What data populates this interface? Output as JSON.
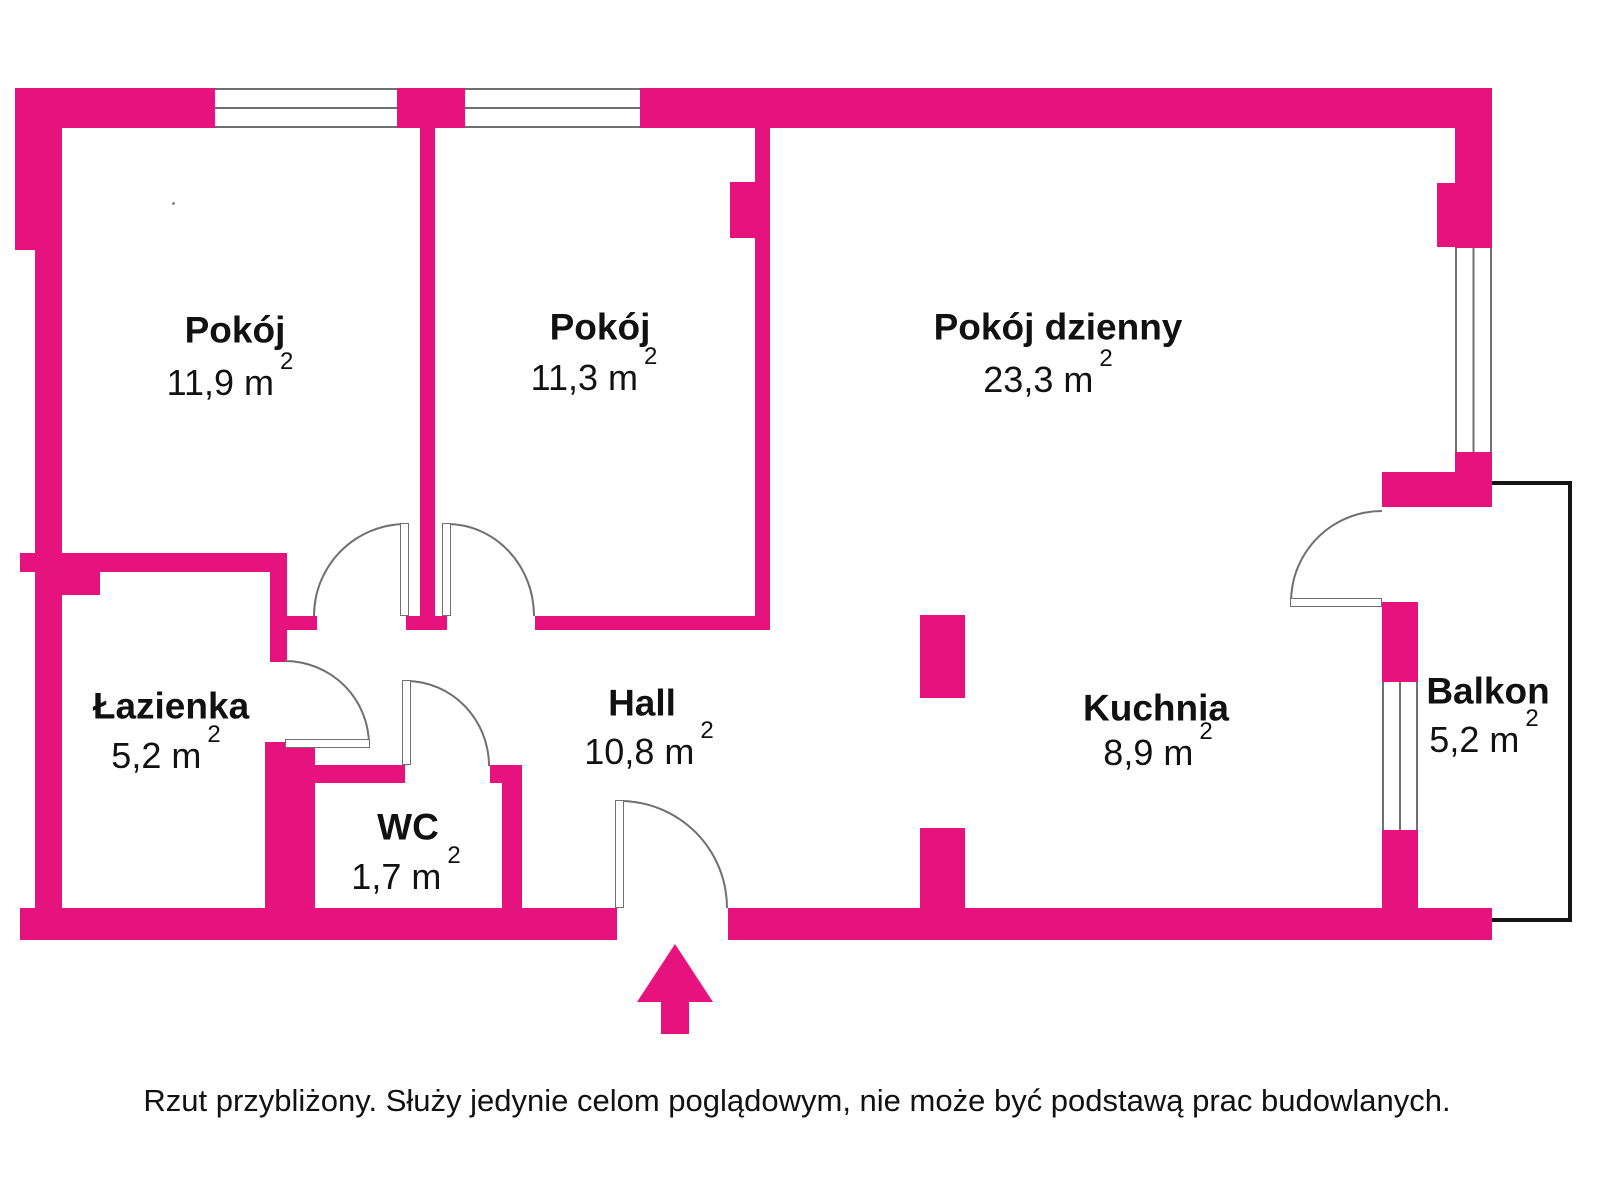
{
  "colors": {
    "wall": "#e6137e",
    "line": "#6f6f6f",
    "balcony": "#141414",
    "text": "#111111"
  },
  "rooms": [
    {
      "name": "Pokój",
      "area": "11,9 m"
    },
    {
      "name": "Pokój",
      "area": "11,3 m"
    },
    {
      "name": "Pokój dzienny",
      "area": "23,3 m"
    },
    {
      "name": "Łazienka",
      "area": "5,2 m"
    },
    {
      "name": "WC",
      "area": "1,7 m"
    },
    {
      "name": "Hall",
      "area": "10,8 m"
    },
    {
      "name": "Kuchnia",
      "area": "8,9 m"
    },
    {
      "name": "Balkon",
      "area": "5,2 m"
    }
  ],
  "superscript": "2",
  "footer": {
    "disclaimer": "Rzut przybliżony. Służy jedynie celom poglądowym, nie może być podstawą prac budowlanych."
  }
}
